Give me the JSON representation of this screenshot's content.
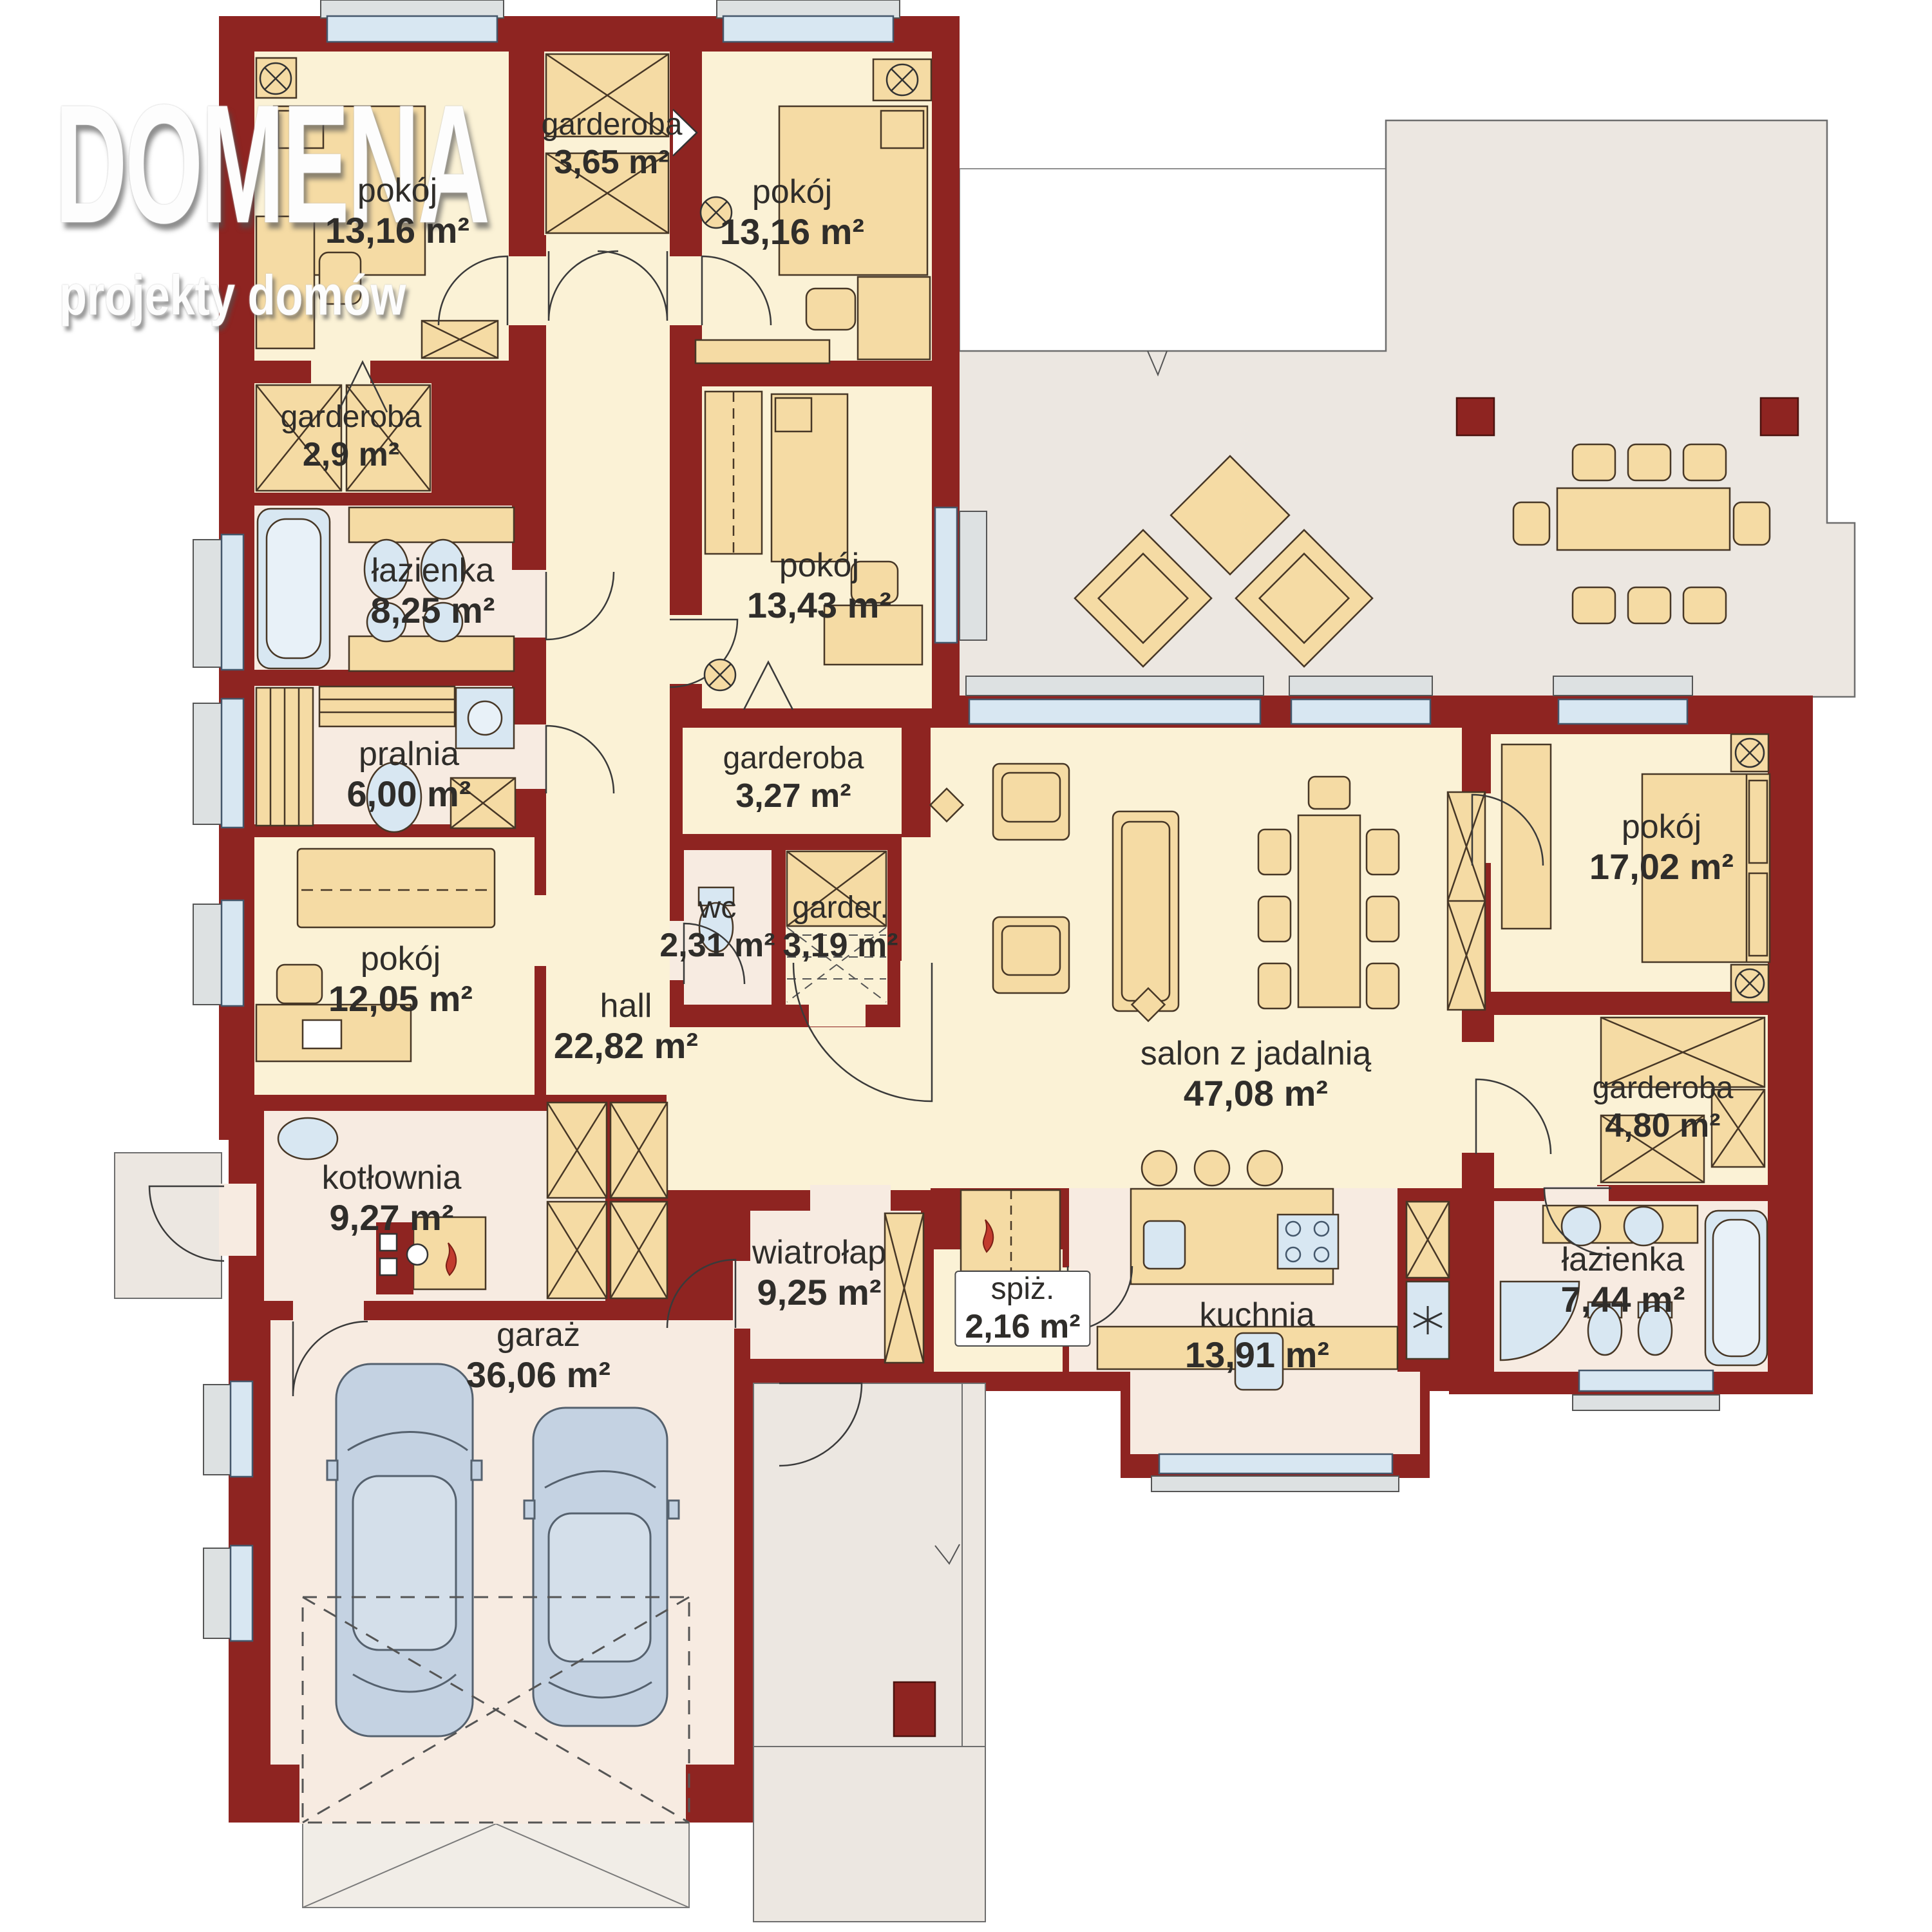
{
  "brand": {
    "name": "DOMENA",
    "tagline": "projekty domów"
  },
  "rooms": [
    {
      "id": "pokoj-1",
      "name": "pokój",
      "area": "13,16 m²"
    },
    {
      "id": "garderoba-1",
      "name": "garderoba",
      "area": "3,65 m²"
    },
    {
      "id": "pokoj-2",
      "name": "pokój",
      "area": "13,16 m²"
    },
    {
      "id": "garderoba-2",
      "name": "garderoba",
      "area": "2,9 m²"
    },
    {
      "id": "lazienka-1",
      "name": "łazienka",
      "area": "8,25 m²"
    },
    {
      "id": "pokoj-3",
      "name": "pokój",
      "area": "13,43 m²"
    },
    {
      "id": "pralnia",
      "name": "pralnia",
      "area": "6,00 m²"
    },
    {
      "id": "garderoba-3",
      "name": "garderoba",
      "area": "3,27 m²"
    },
    {
      "id": "wc",
      "name": "wc",
      "area": "2,31 m²"
    },
    {
      "id": "garderoba-4",
      "name": "garder.",
      "area": "3,19 m²"
    },
    {
      "id": "pokoj-4",
      "name": "pokój",
      "area": "12,05 m²"
    },
    {
      "id": "hall",
      "name": "hall",
      "area": "22,82 m²"
    },
    {
      "id": "salon",
      "name": "salon z jadalnią",
      "area": "47,08 m²"
    },
    {
      "id": "pokoj-5",
      "name": "pokój",
      "area": "17,02 m²"
    },
    {
      "id": "garderoba-5",
      "name": "garderoba",
      "area": "4,80 m²"
    },
    {
      "id": "kotlownia",
      "name": "kotłownia",
      "area": "9,27 m²"
    },
    {
      "id": "wiatrolap",
      "name": "wiatrołap",
      "area": "9,25 m²"
    },
    {
      "id": "spizarnia",
      "name": "spiż.",
      "area": "2,16 m²"
    },
    {
      "id": "kuchnia",
      "name": "kuchnia",
      "area": "13,91 m²"
    },
    {
      "id": "lazienka-2",
      "name": "łazienka",
      "area": "7,44 m²"
    },
    {
      "id": "garaz",
      "name": "garaż",
      "area": "36,06 m²"
    }
  ],
  "palette": {
    "wall": "#8E2421",
    "room": "#FBF2D6",
    "utility": "#F7EBE1",
    "terrace": "#ECE7E1",
    "furniture": "#F5DBA4",
    "fixture": "#D8E7F2",
    "car": "#C4D2E2",
    "flame": "#C23B2E",
    "text": "#2F2D2A",
    "logo": "#FDFDFD"
  }
}
